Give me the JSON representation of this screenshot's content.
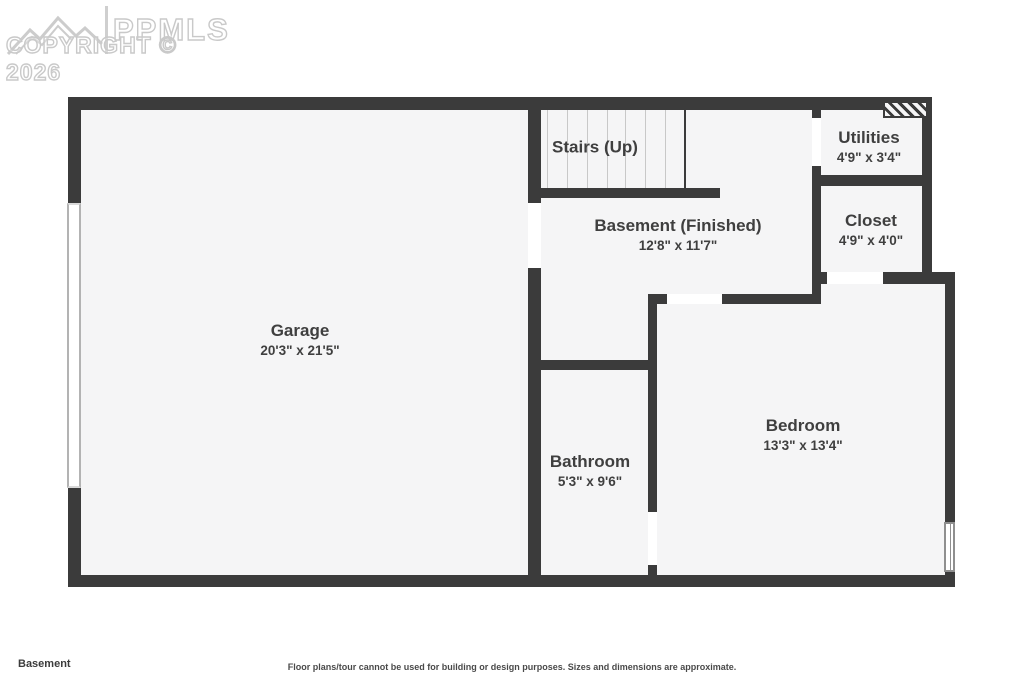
{
  "watermark": {
    "brand": "PPMLS",
    "copyright": "COPYRIGHT © 2026",
    "logo_icon": "mountain-logo"
  },
  "rooms": [
    {
      "id": "garage",
      "name": "Garage",
      "dims": "20'3\" x 21'5\""
    },
    {
      "id": "stairs",
      "name": "Stairs (Up)",
      "dims": ""
    },
    {
      "id": "basement",
      "name": "Basement (Finished)",
      "dims": "12'8\" x 11'7\""
    },
    {
      "id": "utilities",
      "name": "Utilities",
      "dims": "4'9\" x 3'4\""
    },
    {
      "id": "closet",
      "name": "Closet",
      "dims": "4'9\" x 4'0\""
    },
    {
      "id": "bathroom",
      "name": "Bathroom",
      "dims": "5'3\" x 9'6\""
    },
    {
      "id": "bedroom",
      "name": "Bedroom",
      "dims": "13'3\" x 13'4\""
    }
  ],
  "footer": {
    "floor_label": "Basement",
    "disclaimer": "Floor plans/tour cannot be used for building or design purposes. Sizes and dimensions are approximate."
  },
  "colors": {
    "wall": "#3b3b3b",
    "floor": "#f5f5f6",
    "label_text": "#3f3f3f",
    "watermark": "#c9c9c9",
    "stair_tread": "#c8c8c8",
    "background": "#ffffff"
  }
}
